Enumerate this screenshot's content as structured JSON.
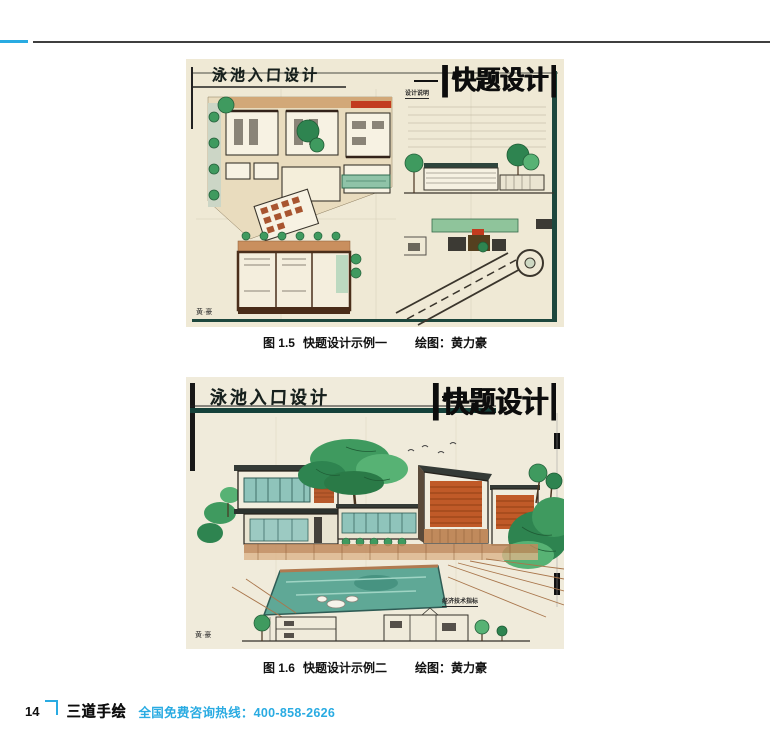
{
  "page": {
    "number": "14",
    "brand": "三道手绘",
    "hotline": "全国免费咨询热线：400-858-2626"
  },
  "figures": [
    {
      "drawing_title": "泳池入口设计",
      "corner_logo": "快题设计",
      "notes_label": "设计说明",
      "signature": "黄·豪",
      "caption_label": "图 1.5",
      "caption_title": "快题设计示例一",
      "credit": "绘图：黄力豪",
      "content": "hand-drawn marker sketch: floor plans, elevation and site plan of a swimming-pool entrance design"
    },
    {
      "drawing_title": "泳池入口设计",
      "corner_logo": "快题设计",
      "notes_label": "经济技术指标",
      "signature": "黄·豪",
      "caption_label": "图 1.6",
      "caption_title": "快题设计示例二",
      "credit": "绘图：黄力豪",
      "content": "hand-drawn marker perspective rendering of modern buildings with swimming pool, plus section drawing"
    }
  ],
  "colors": {
    "accent_cyan": "#29abe2",
    "header_rule": "#3f3f3f",
    "paper": "#efe9d5",
    "teal_border": "#1d473d",
    "tree_green": "#3f9a5f",
    "dark_green": "#2e8450",
    "accent_red": "#c23b1f",
    "wood_orange": "#c05a28",
    "tan_floor": "#c98f5e",
    "pool_teal": "#5fa896"
  }
}
